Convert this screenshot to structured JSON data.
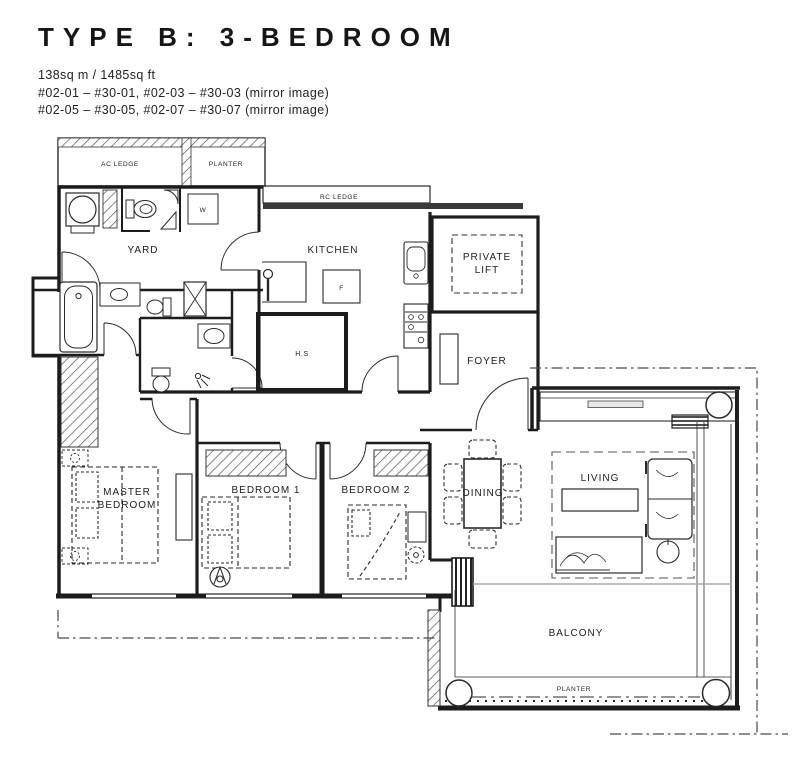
{
  "header": {
    "title": "TYPE B: 3-BEDROOM",
    "area": "138sq m / 1485sq ft",
    "units_line1": "#02-01 – #30-01, #02-03 – #30-03 (mirror image)",
    "units_line2": "#02-05 – #30-05, #02-07 – #30-07 (mirror image)"
  },
  "rooms": {
    "ac_ledge": "AC LEDGE",
    "planter_top": "PLANTER",
    "rc_ledge": "RC LEDGE",
    "yard": "YARD",
    "kitchen": "KITCHEN",
    "washer": "W",
    "fridge": "F",
    "household_shelter": "H.S",
    "private_lift_line1": "PRIVATE",
    "private_lift_line2": "LIFT",
    "foyer": "FOYER",
    "master_line1": "MASTER",
    "master_line2": "BEDROOM",
    "bedroom1": "BEDROOM 1",
    "bedroom2": "BEDROOM 2",
    "dining": "DINING",
    "living": "LIVING",
    "balcony": "BALCONY",
    "planter_balcony": "PLANTER"
  },
  "colors": {
    "ink": "#1c1c1c",
    "band": "#3a3a3a",
    "background": "#ffffff"
  }
}
